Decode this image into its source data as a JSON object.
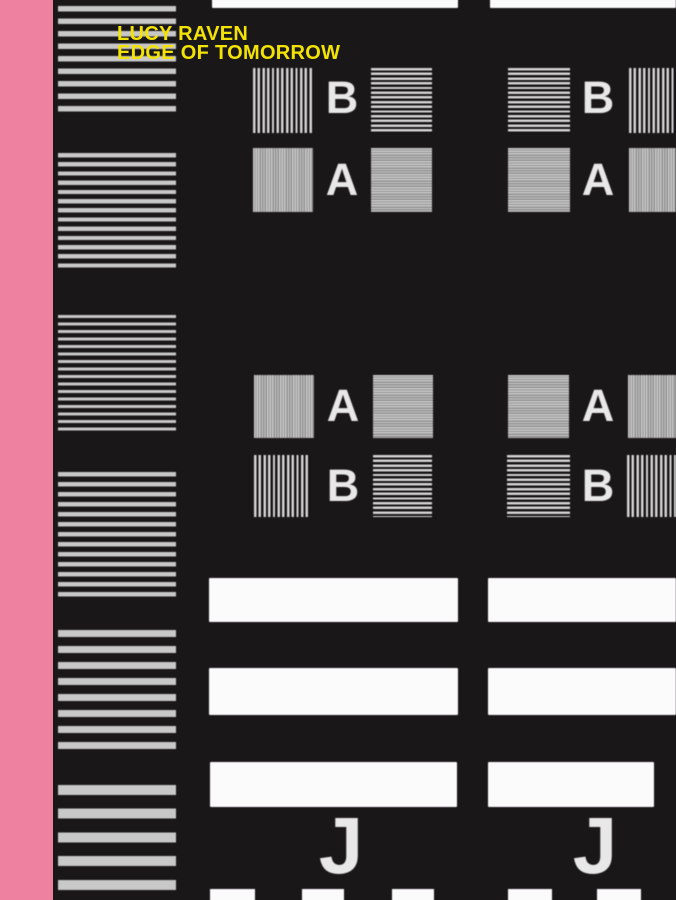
{
  "cover": {
    "title": {
      "line1": "LUCY RAVEN",
      "line2": "EDGE OF TOMORROW"
    },
    "labels": {
      "a": "A",
      "b": "B",
      "j": "J"
    },
    "colors": {
      "spine_pink": "#ee81a0",
      "background": "#1a1718",
      "title_yellow": "#f3e304",
      "stripe_gray": "#c8c8c8",
      "bar_white": "#fbfbfb",
      "letter_white": "#e8e8e8"
    }
  }
}
